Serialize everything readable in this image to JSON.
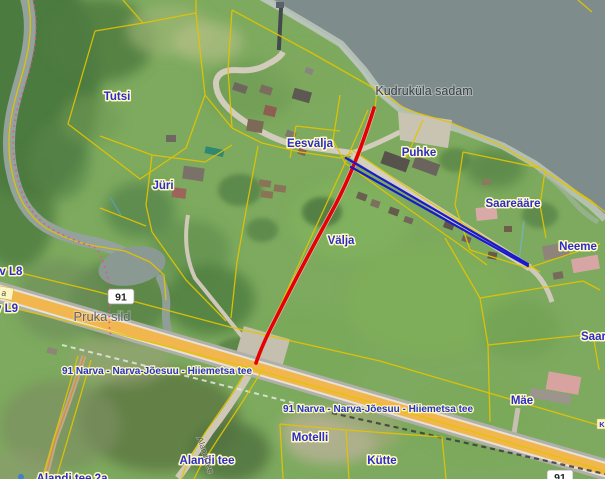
{
  "map": {
    "labels": {
      "tutsi": "Tutsi",
      "kudrukula_sadam": "Kudruküla sadam",
      "eesvalja": "Eesvälja",
      "puhke": "Puhke",
      "jyri": "Jüri",
      "saareaare": "Saareääre",
      "valja": "Välja",
      "neeme": "Neeme",
      "motelli": "Motelli",
      "kytte": "Kütte",
      "alandi_tee": "Alandi tee",
      "alandi_tee_2a": "Alandi tee 2a",
      "alandi_street_rotated": "Alandi tee",
      "mae": "Mäe",
      "saare": "Saare",
      "pruka_sild": "Pruka sild",
      "av_l8": "av L8",
      "v_l9": "v L9",
      "a_badge": "a",
      "k_badge": "K"
    },
    "roads": {
      "route_number": "91",
      "highway_label": "91 Narva - Narva-Jõesuu - Hiiemetsa tee"
    },
    "annotations": {
      "red_line": {
        "color": "#e60000",
        "from": [
          374,
          108
        ],
        "to": [
          256,
          363
        ]
      },
      "blue_line": {
        "color": "#1a1acc",
        "from": [
          346,
          158
        ],
        "to": [
          528,
          265
        ]
      }
    },
    "colors": {
      "water": "#7e8d8b",
      "river": "#93a29b",
      "parcel_boundary": "#e3c400",
      "road_fill": "#f2b64f",
      "label_text": "#2b2bd0",
      "label_halo": "#fffbc0",
      "municipal_boundary_pink": "#e0559a"
    }
  }
}
